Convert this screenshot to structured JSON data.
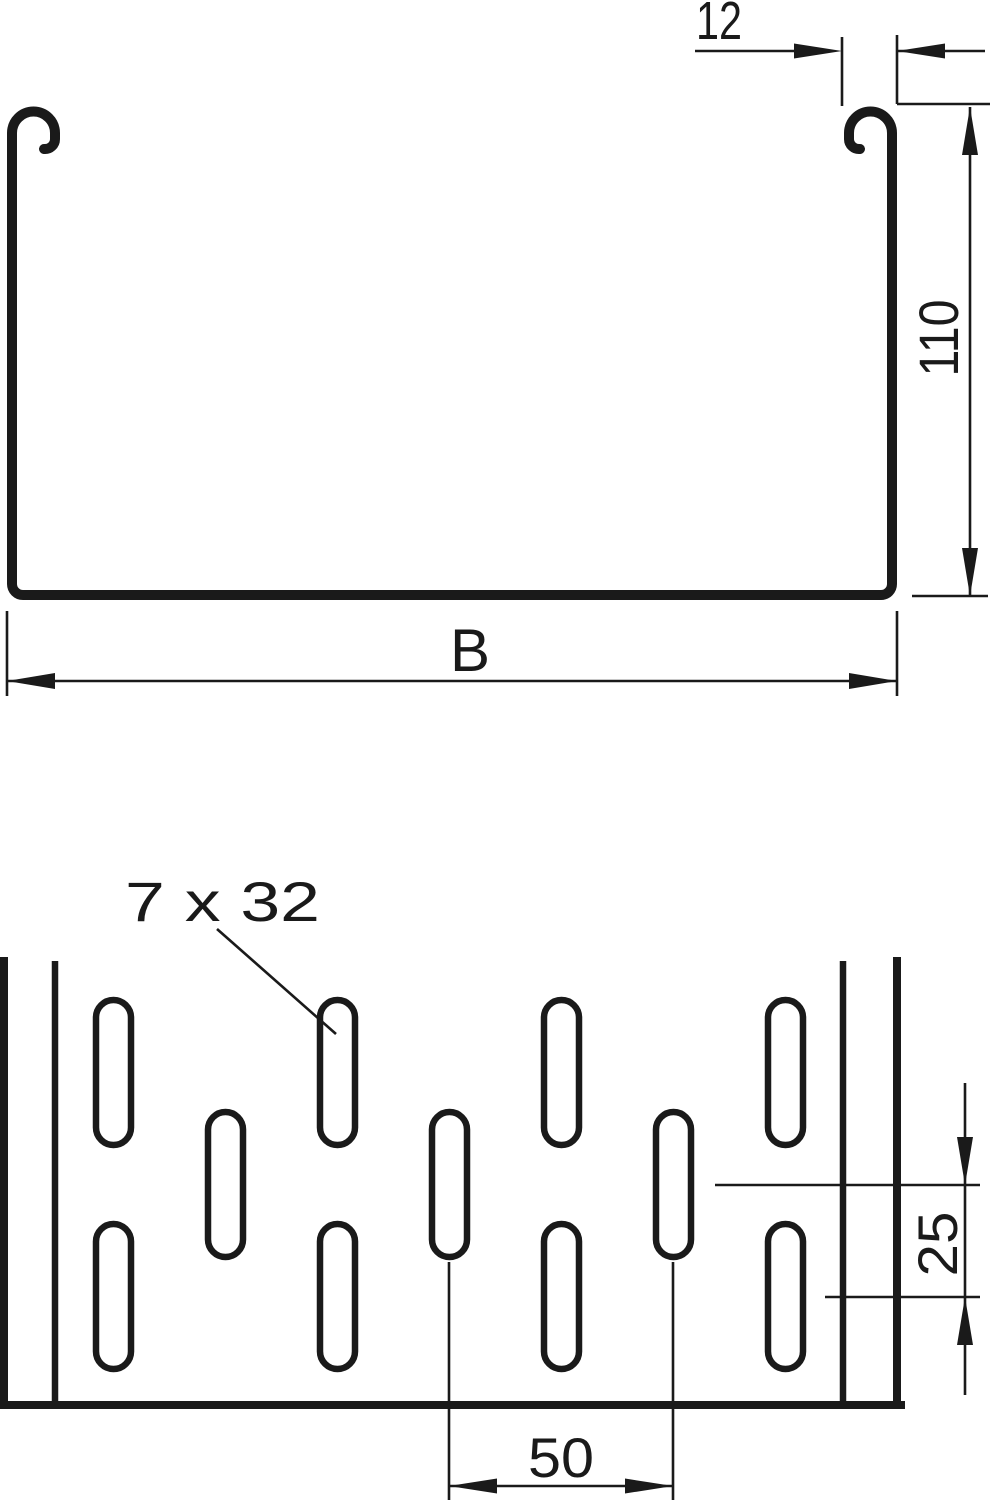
{
  "colors": {
    "ink": "#1a1a1a",
    "background": "#ffffff"
  },
  "cross_section": {
    "flange_lip_width_label": "12",
    "side_height_label": "110",
    "tray_width_label": "B"
  },
  "plan_view": {
    "slot_size_label": "7 x 32",
    "slot_row_offset_label": "25",
    "slot_pitch_label": "50"
  }
}
